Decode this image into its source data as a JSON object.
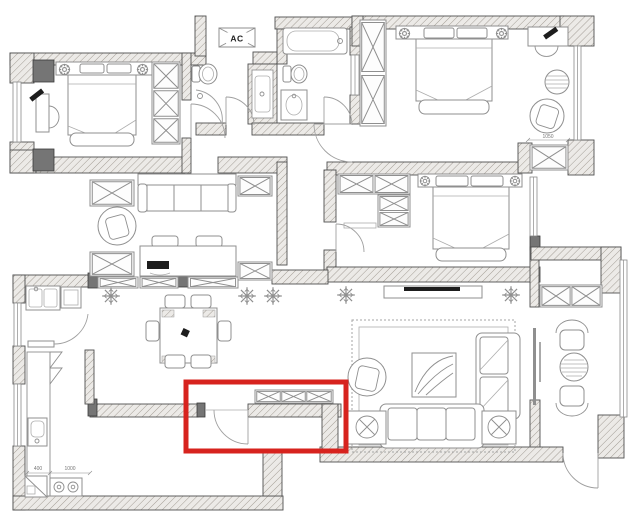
{
  "document": {
    "type": "architectural floor plan",
    "description": "Black-and-white CAD apartment floor plan; a red rectangle highlights the entry hallway door and shoe-cabinet wall near the bottom center"
  },
  "labels": {
    "ac_unit": "AC",
    "kitchen_dim_left": "400",
    "kitchen_dim_right": "1000",
    "master_cabinet_dim": "1050"
  },
  "highlight_box": {
    "x": 186,
    "y": 382,
    "width": 160,
    "height": 69,
    "stroke_color": "#d7231e",
    "stroke_width": 5,
    "marks": "entry hallway door and shoe cabinet area"
  },
  "colors": {
    "background": "#ffffff",
    "wall_outline": "#4f4f4f",
    "wall_fill": "#eceae7",
    "wall_hatch_line": "#a39d95",
    "column_fill": "#757575",
    "furniture_line": "#8f8f8f",
    "text": "#222222",
    "dimension_text": "#777777",
    "highlight": "#d7231e"
  },
  "symbols": {
    "x_box": "cabinet / wardrobe cell drawn as crossed box",
    "plant": "potted plant asterisk glyph",
    "lamp": "bedside lamp gear glyph",
    "door_arc": "door swing quarter arc",
    "double_line": "window"
  }
}
